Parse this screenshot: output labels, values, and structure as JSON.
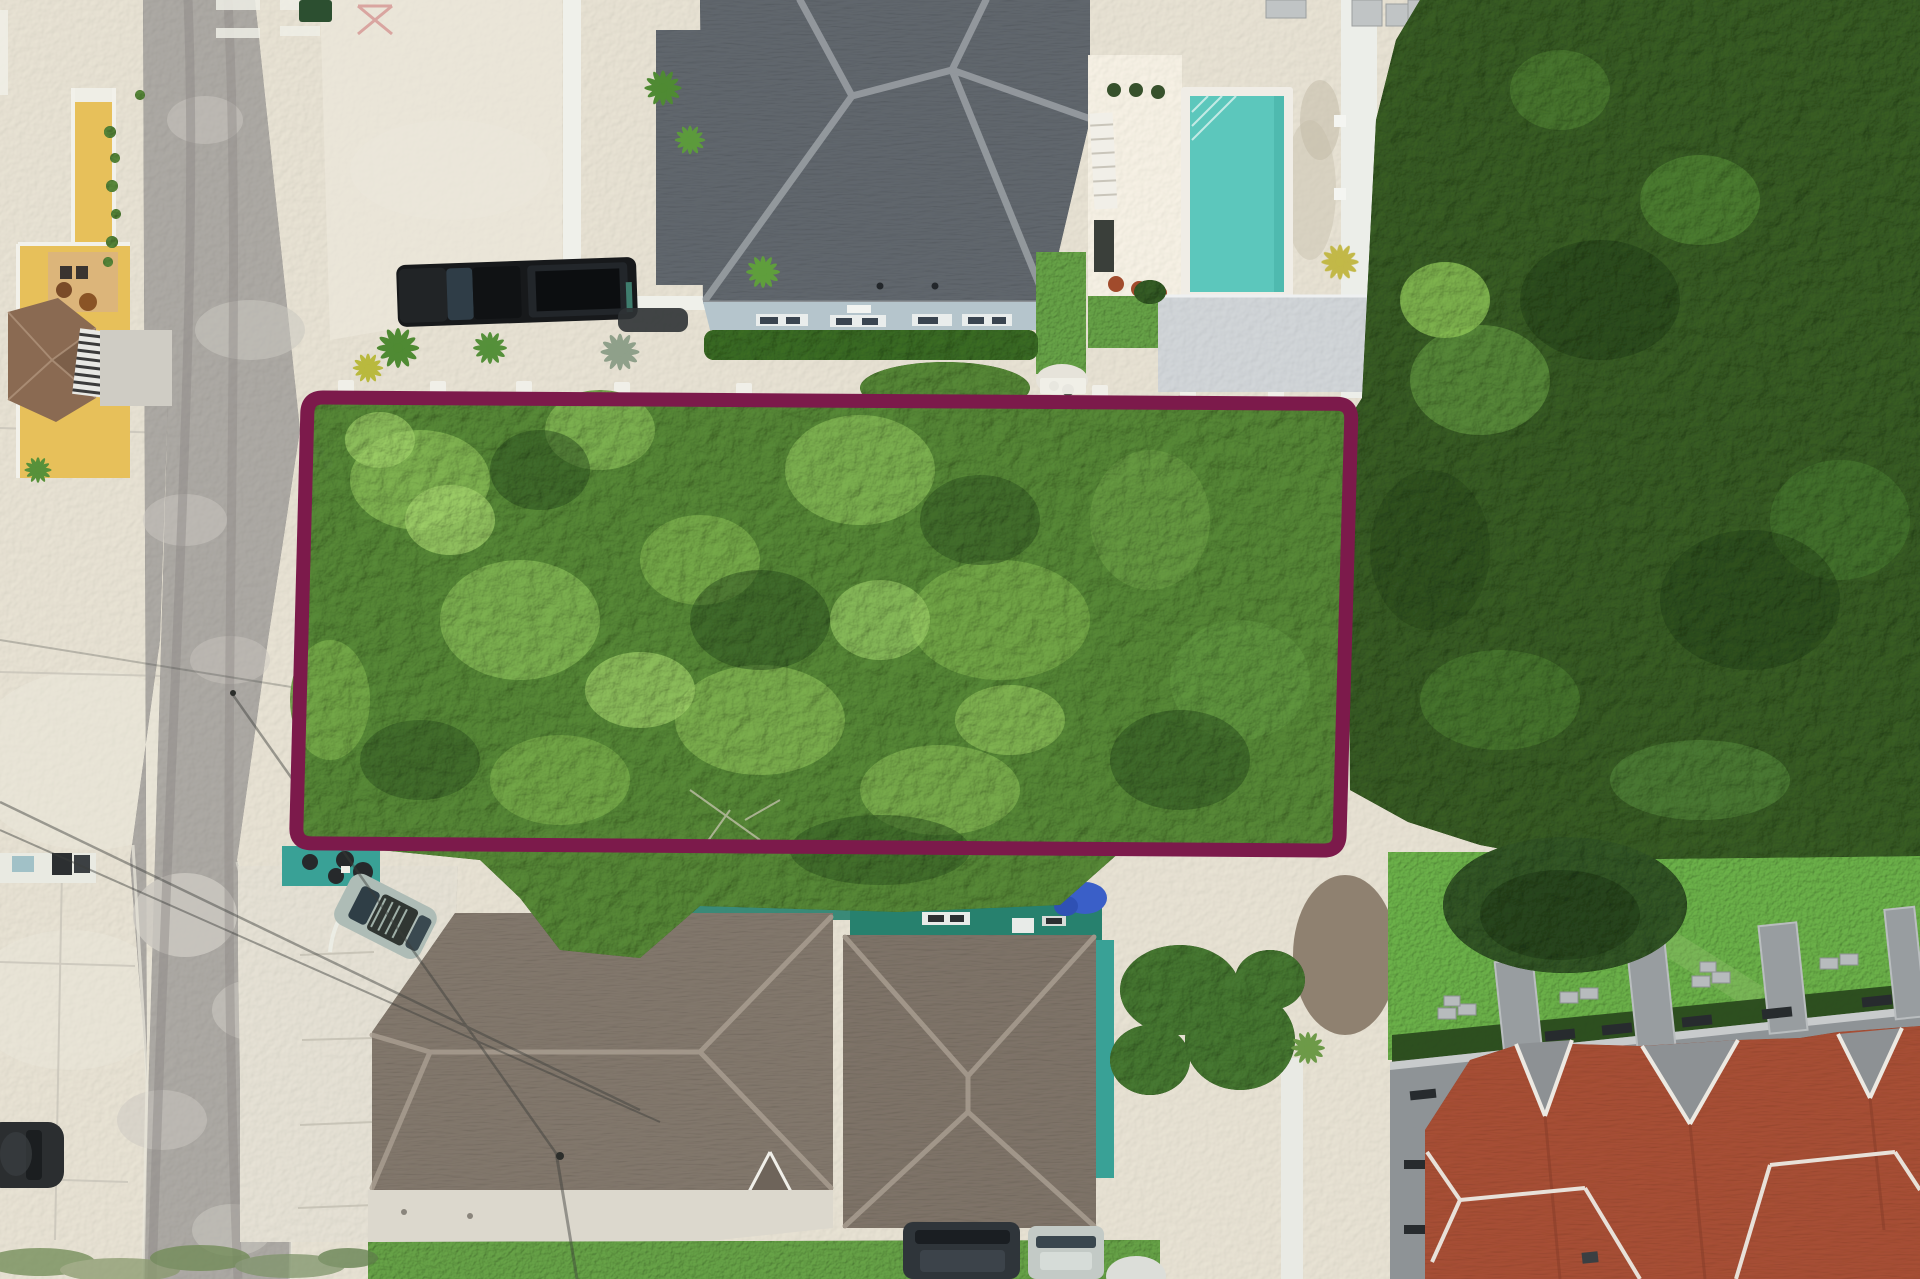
{
  "meta": {
    "description": "Aerial drone photograph of a rectangular tree-covered vacant lot outlined with a maroon boundary, between residential houses, a road on the left and dense forest on the right",
    "canvas_width": 1920,
    "canvas_height": 1279
  },
  "boundary": {
    "label": "lot-boundary-outline",
    "color": "#7c1a4b",
    "stroke_width": 14,
    "corner_radius": 16
  },
  "palette": {
    "sand": "#dbd6c8",
    "sand_bright": "#ece8db",
    "road": "#a3a09b",
    "road_light": "#cbc8c1",
    "road_dark": "#8b8884",
    "concrete_pad": "#d9d5c9",
    "white_trim": "#efeee6",
    "lot_canopy": "#4d7a30",
    "lot_canopy_light": "#7aa94d",
    "lot_canopy_bright": "#95c162",
    "lot_canopy_shadow": "#24431a",
    "forest": "#31521f",
    "forest_light": "#568538",
    "forest_shadow": "#1d3513",
    "roof_slate": "#5b6167",
    "roof_ridge": "#989da2",
    "house_wall": "#b5c5cc",
    "window_dark": "#3a4550",
    "hedge": "#33601f",
    "pool_deck": "#e9e4d8",
    "pool_water": "#5cc7bc",
    "pool_water_edge": "#46b1a6",
    "pool_coping": "#f0ede6",
    "shed_roof": "#c6cacd",
    "grass": "#5d9440",
    "yellow_wall": "#e7c05a",
    "gazebo_roof": "#8a6a52",
    "truck": "#17191b",
    "car_silver": "#aebcb6",
    "car_dark": "#2f353a",
    "car_black": "#2b2e30",
    "teal_roof": "#27816e",
    "teal_wall": "#39a196",
    "tarp_blue": "#3a5fc8",
    "roof_brown": "#7b7166",
    "roof_brown_right": "#776d62",
    "roof_brown_ridge": "#a89d90",
    "walkway": "#dcd8cd",
    "lawn": "#61a142",
    "lawn_tree": "#2c4c20",
    "dark_hedge": "#2a4a1e",
    "town_wall": "#8e9396",
    "block_gray": "#b7bbbd",
    "party_wall": "#989da0",
    "window_slot": "#272b2e",
    "roof_red": "#9e4a31",
    "roof_red_line": "#ece9e2",
    "dirt": "#8f8170",
    "wire": "#3b3d3a"
  },
  "scene_objects": [
    {
      "name": "asphalt-road",
      "label": "Asphalt road running along the left side"
    },
    {
      "name": "lot-boundary",
      "label": "Maroon rectangular property boundary overlay"
    },
    {
      "name": "vacant-lot-trees",
      "label": "Tree-covered vacant lot inside the boundary"
    },
    {
      "name": "forest",
      "label": "Dense dark forest on the right"
    },
    {
      "name": "gray-roof-house",
      "label": "House with dark gray hip roof at top"
    },
    {
      "name": "swimming-pool",
      "label": "Turquoise swimming pool with white coping"
    },
    {
      "name": "pool-shed",
      "label": "Light gray shed roof below the pool"
    },
    {
      "name": "yellow-building",
      "label": "Yellow building with brown gazebo at top left"
    },
    {
      "name": "black-pickup-truck",
      "label": "Black pickup truck in sandy yard"
    },
    {
      "name": "brown-roof-houses",
      "label": "Houses with brown hip roofs at bottom"
    },
    {
      "name": "teal-flat-roof",
      "label": "Teal flat-roofed building behind brown roofs"
    },
    {
      "name": "townhouses-red-roof",
      "label": "Townhouses with red tile roofs at bottom right"
    },
    {
      "name": "lawn",
      "label": "Green lawn with large dark tree"
    },
    {
      "name": "parked-cars",
      "label": "Parked cars along road and driveways"
    },
    {
      "name": "power-lines",
      "label": "Overhead power lines crossing the road"
    }
  ]
}
